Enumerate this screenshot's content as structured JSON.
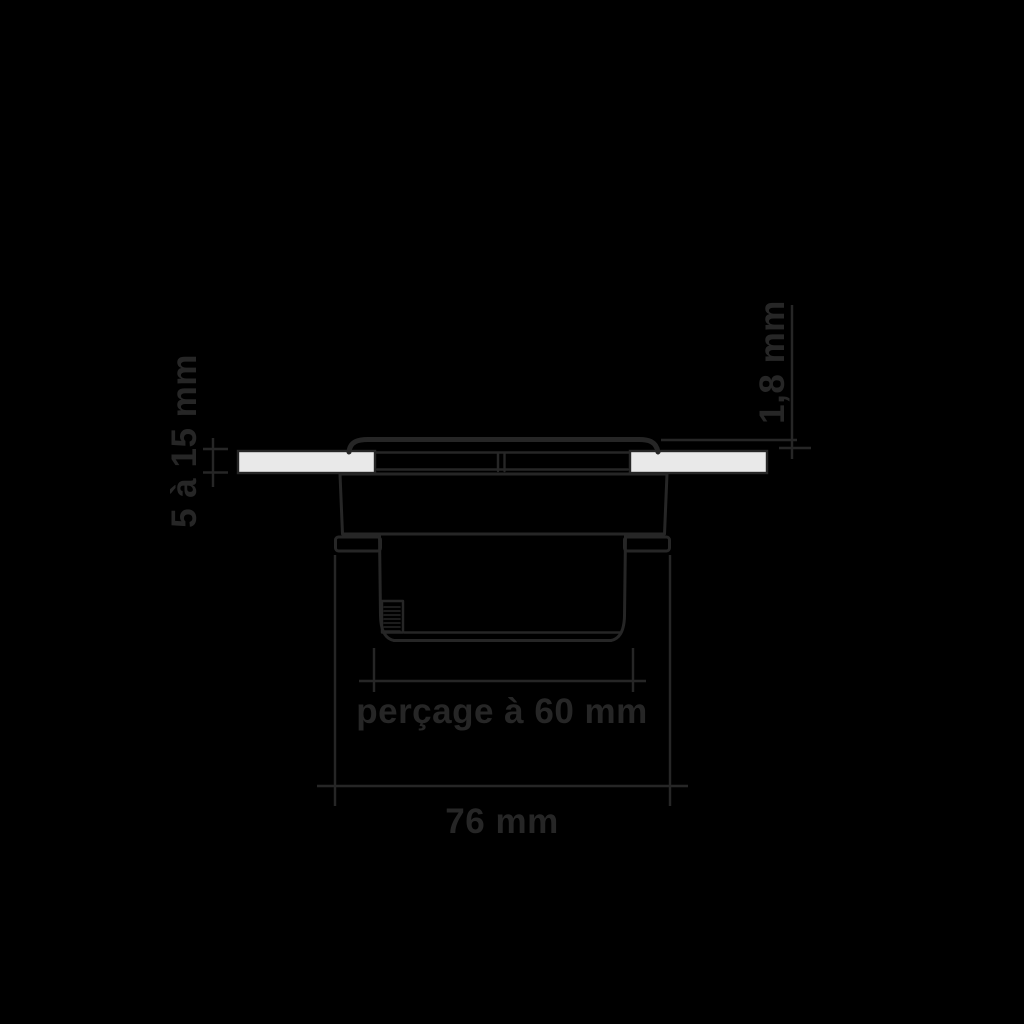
{
  "colors": {
    "background": "#000000",
    "line": "#262626",
    "panel_fill": "#e9e9e9"
  },
  "diagram": {
    "dimensions": {
      "panel_thickness": {
        "label": "5 à 15 mm",
        "orientation": "vertical"
      },
      "flange_thickness": {
        "label": "1,8 mm",
        "orientation": "vertical"
      },
      "hole": {
        "label": "perçage à 60 mm",
        "orientation": "horizontal"
      },
      "overall_width": {
        "label": "76 mm",
        "orientation": "horizontal"
      }
    }
  }
}
